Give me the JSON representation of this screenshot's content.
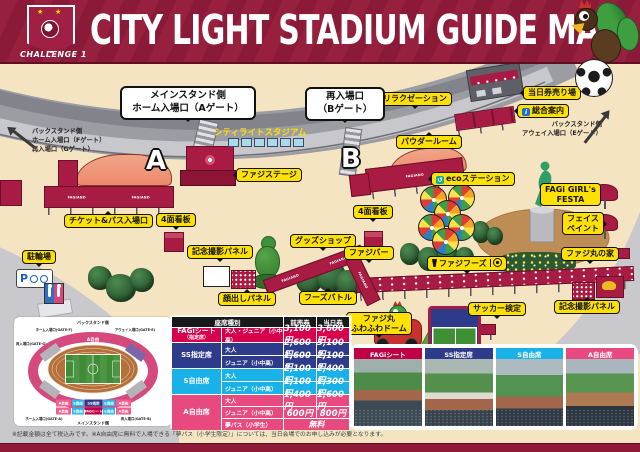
{
  "colors": {
    "header_crimson": "#8e1a38",
    "label_yellow": "#ffe100",
    "tent_crimson": "#a81b42",
    "cream": "#f4e4c2",
    "row_fagi": "#d6004c",
    "row_ss": "#2e3b8a",
    "row_s": "#18b2e8",
    "row_a": "#e8497e"
  },
  "header": {
    "title": "CITY LIGHT STADIUM GUIDE MAP",
    "badge": "CHALLENGE 1"
  },
  "map": {
    "stadium_name": "シティライトスタジアム",
    "tent_brand": "FAGIANO",
    "gate_letter_a": "A",
    "gate_letter_b": "B",
    "bubble_a": "メインスタンド側\nホーム入場口（Aゲート）",
    "bubble_b": "再入場口\n（Bゲート）",
    "note_fg": "バックスタンド側\nホーム入場口（Fゲート）\n再入場口（Gゲート）",
    "note_e": "バックスタンド側\nアウェイ入場口（Eゲート）",
    "icons": {
      "info": "i",
      "eco": "↺",
      "parking": "P"
    },
    "labels": {
      "relaxation": "リラクゼーション",
      "day_ticket": "当日券売り場",
      "info": "総合案内",
      "powder_room": "パウダールーム",
      "eco_station": "ecoステーション",
      "fagi_girls": "FAGi GIRL's\nFESTA",
      "face_paint": "フェイス\nペイント",
      "fajimaru_house": "ファジ丸の家",
      "faji_foods": "ファジフーズ",
      "soccer_test": "サッカー検定",
      "photo_panel_right": "記念撮影パネル",
      "photo_panel_left": "記念撮影パネル",
      "billboard_left": "4面看板",
      "billboard_mid": "4面看板",
      "ticket_pass": "チケット&パス入場口",
      "bicycle_parking": "駐輪場",
      "faji_stage": "ファジステージ",
      "goods_shop": "グッズショップ",
      "faji_bar": "ファジバー",
      "kaodashi_panel": "顔出しパネル",
      "foods_battle": "フーズバトル",
      "fuwafuwa_dome": "ファジ丸\nふわふわドーム"
    }
  },
  "seatmap": {
    "back_stand": "バックスタンド側",
    "main_stand": "メインスタンド側",
    "gate_f": "ホーム入場口(GATE-F)",
    "gate_g": "再入場口(GATE-G)",
    "gate_e": "アウェイ入場口(GATE-E)",
    "gate_a": "ホーム入場口(GATE-A)",
    "gate_b": "再入場口(GATE-B)",
    "top_band": "A自由",
    "row1": [
      "A自由",
      "S自由",
      "SS指定",
      "S自由",
      "A自由"
    ],
    "row2": [
      "A自由",
      "S自由",
      "FAGiシート",
      "S自由",
      "A自由"
    ]
  },
  "price_table": {
    "header": {
      "seat": "座席種別",
      "advance": "前売券",
      "day": "当日券"
    },
    "fagi": {
      "name": "FAGiシート",
      "name_sub": "（指定席）",
      "type": "大人・ジュニア（小中高）",
      "advance": "3,100円",
      "day": "3,600円"
    },
    "ss": {
      "name": "SS指定席",
      "adult": {
        "type": "大人",
        "advance": "2,600円",
        "day": "3,100円"
      },
      "junior": {
        "type": "ジュニア（小中高）",
        "advance": "1,600円",
        "day": "2,100円"
      }
    },
    "s": {
      "name": "S自由席",
      "adult": {
        "type": "大人",
        "advance": "2,100円",
        "day": "2,400円"
      },
      "junior": {
        "type": "ジュニア（小中高）",
        "advance": "1,100円",
        "day": "1,300円"
      }
    },
    "a": {
      "name": "A自由席",
      "adult": {
        "type": "大人",
        "advance": "1,400円",
        "day": "1,600円"
      },
      "junior": {
        "type": "ジュニア（小中高）",
        "advance": "600円",
        "day": "800円"
      },
      "yume": {
        "type": "夢パス（小学生）",
        "price": "無料"
      }
    }
  },
  "photos": {
    "items": [
      {
        "label": "FAGiシート"
      },
      {
        "label": "SS指定席"
      },
      {
        "label": "S自由席"
      },
      {
        "label": "A自由席"
      }
    ]
  },
  "footer": {
    "disclaimer": "※記載金額は全て税込みです。※A自由席に無料で入場できる「夢パス（小学生限定）」については、当日会場でのお申し込みが必要となります。"
  }
}
